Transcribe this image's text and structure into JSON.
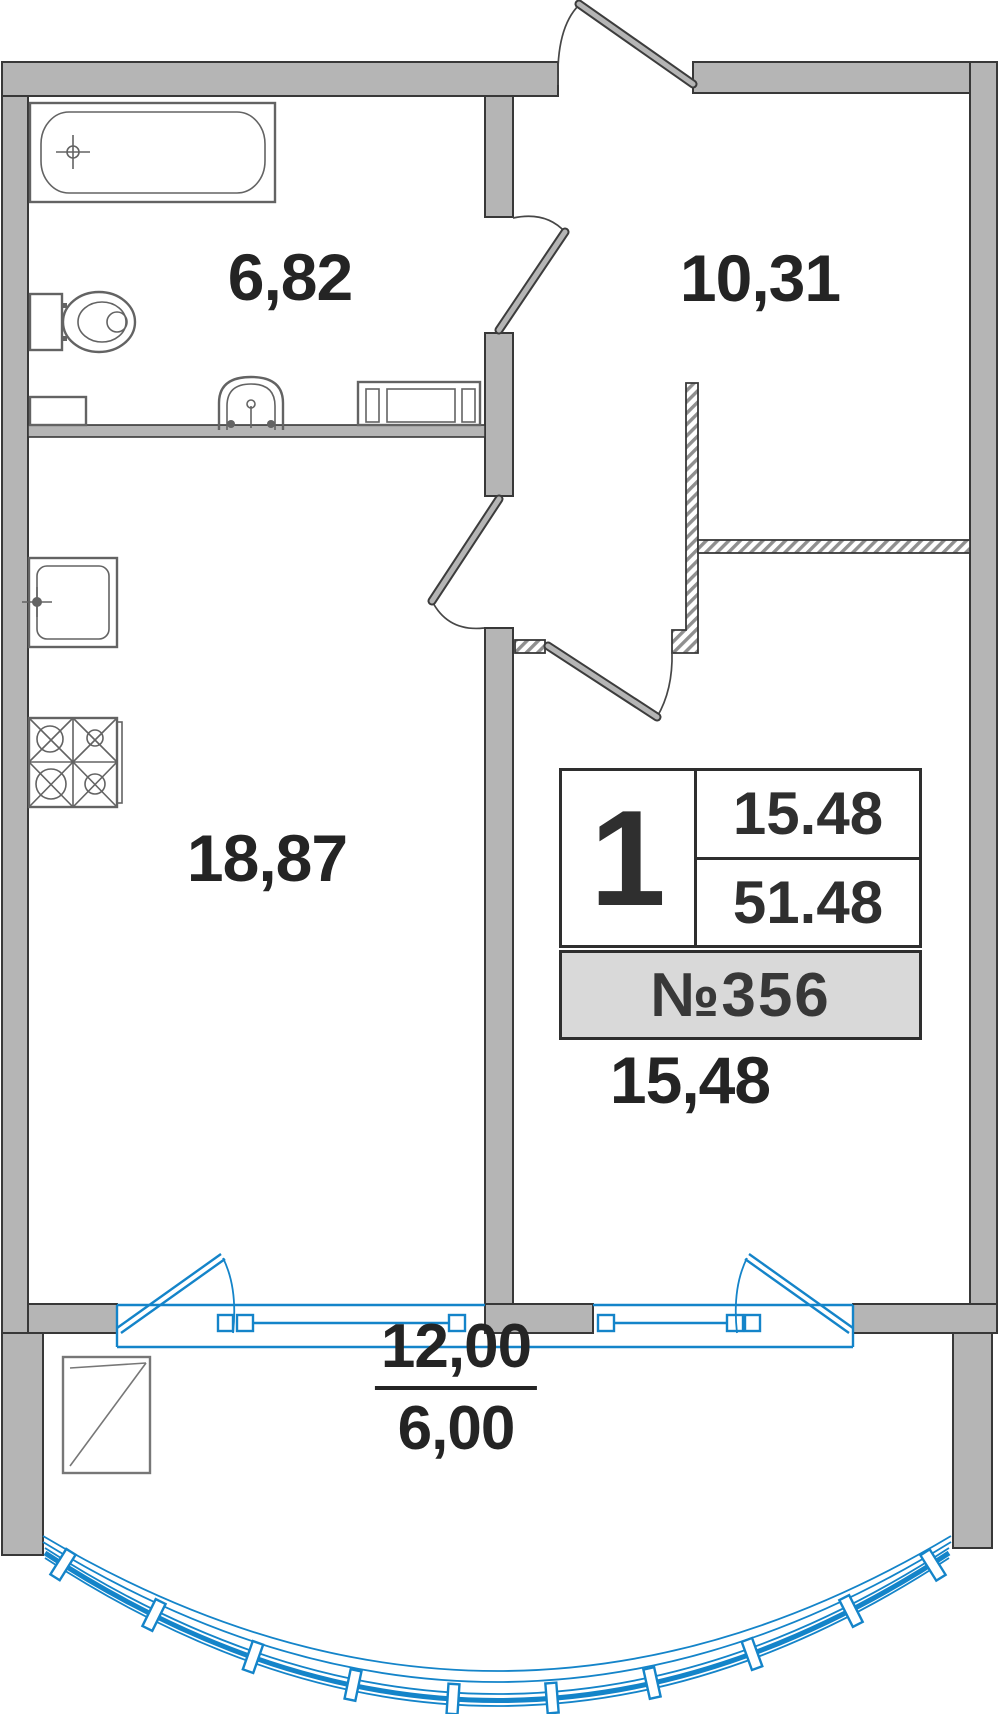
{
  "title": "Apartment floor plan",
  "colors": {
    "wall_fill": "#b5b5b5",
    "line": "#383838",
    "fixture": "#636363",
    "window": "#1484c9",
    "label": "#242424",
    "unit_row_bg": "#d9d9d9"
  },
  "rooms": [
    {
      "id": "bathroom",
      "label": "6,82"
    },
    {
      "id": "hallway",
      "label": "10,31"
    },
    {
      "id": "kitchen-living",
      "label": "18,87"
    },
    {
      "id": "bedroom",
      "label": "15,48"
    }
  ],
  "balcony": {
    "area_full": "12,00",
    "area_reduced": "6,00"
  },
  "unit_card": {
    "rooms_count": "1",
    "living_area": "15.48",
    "total_area": "51.48",
    "unit_number": "№356"
  }
}
